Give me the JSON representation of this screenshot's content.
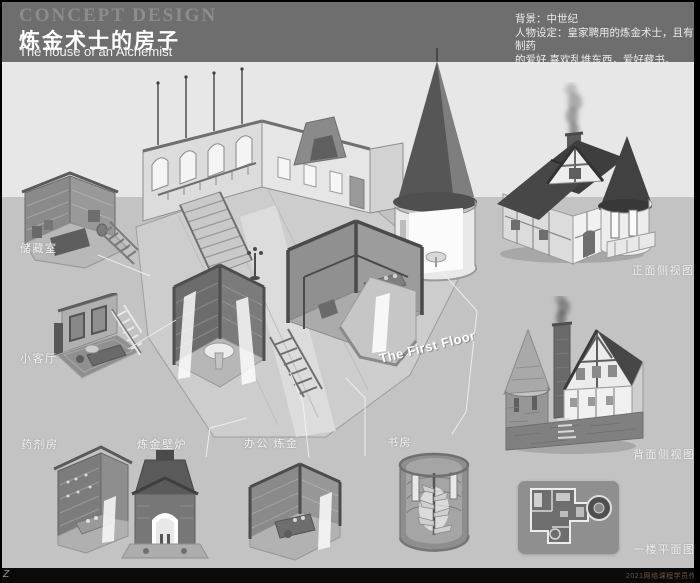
{
  "colors": {
    "header_bg": "#6e6e6e",
    "band_light": "#e7e7e7",
    "band_mid": "#c3c3c3",
    "footer_bg": "#0a0a0a",
    "label_text": "#f2f2f2",
    "callout_line": "#f5f5f5",
    "frame": "#000000"
  },
  "header": {
    "kicker": "CONCEPT DESIGN",
    "title_cn": "炼金术士的房子",
    "title_en": "The house of an Alchemist",
    "notes": [
      "背景：中世纪",
      "人物设定：皇家聘用的炼金术士，且有制药",
      "的爱好.喜欢乱堆东西，爱好藏书。"
    ]
  },
  "main_illustration": {
    "caption": "The First Floor"
  },
  "rooms": [
    {
      "id": "storage",
      "label": "储藏室"
    },
    {
      "id": "parlor",
      "label": "小客厅"
    },
    {
      "id": "pharmacy",
      "label": "药剂房"
    },
    {
      "id": "alchemy-hearth",
      "label": "炼金壁炉"
    },
    {
      "id": "office-alchemy",
      "label": "办公 炼金"
    },
    {
      "id": "study",
      "label": "书房"
    }
  ],
  "exterior_views": [
    {
      "id": "front",
      "label": "正面侧视图"
    },
    {
      "id": "back",
      "label": "背面侧视图"
    },
    {
      "id": "plan",
      "label": "一楼平面图"
    }
  ],
  "footer": {
    "corner_mark": "Z",
    "watermark": "2021网络课程学员作品"
  }
}
